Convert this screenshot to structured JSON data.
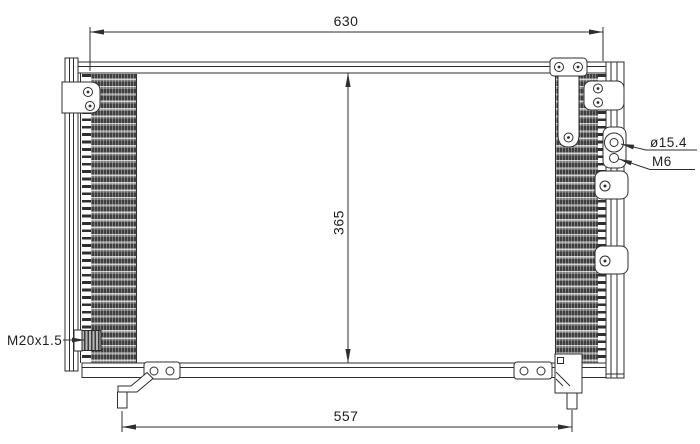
{
  "drawing": {
    "kind": "technical-drawing",
    "background_color": "#ffffff",
    "line_color": "#2e2e2e",
    "fin_dark_color": "#3f3f3f",
    "fin_light_color": "#cfcfcf",
    "dimensions": {
      "overall_width_mm": "630",
      "core_height_mm": "365",
      "mounting_pin_span_mm": "557"
    },
    "callouts": {
      "port_diameter": "ø15.4",
      "port_bolt_thread": "M6",
      "fitting_thread": "M20x1.5"
    }
  }
}
